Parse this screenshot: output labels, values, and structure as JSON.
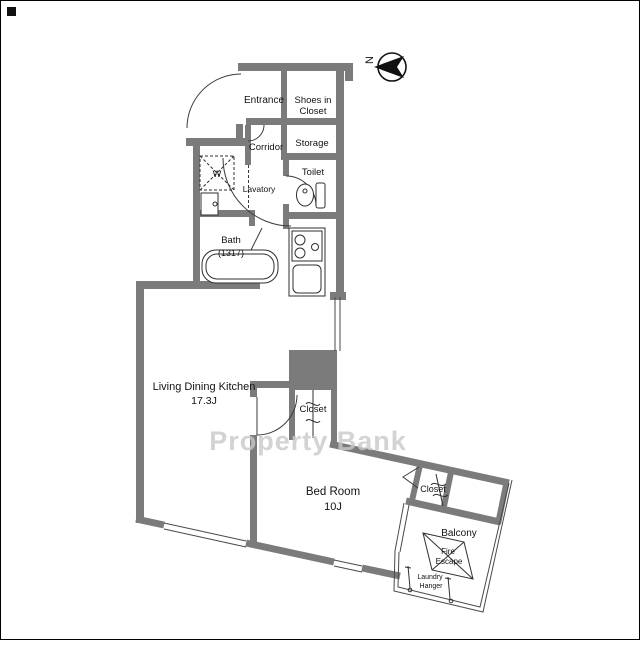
{
  "plan": {
    "watermark": "Property Bank",
    "compass": {
      "north_label": "N"
    },
    "rooms": {
      "entrance": {
        "label": "Entrance"
      },
      "shoes_in_closet": {
        "line1": "Shoes in",
        "line2": "Closet"
      },
      "corridor": {
        "label": "Corridor"
      },
      "storage": {
        "label": "Storage"
      },
      "toilet": {
        "label": "Toilet"
      },
      "washing_machine": {
        "label": "W"
      },
      "lavatory": {
        "label": "Lavatory"
      },
      "bath": {
        "label": "Bath",
        "size": "(1317)"
      },
      "living_dining_kitchen": {
        "label": "Living Dining Kitchen",
        "size": "17.3J"
      },
      "hall_closet": {
        "label": "Closet"
      },
      "bedroom": {
        "label": "Bed Room",
        "size": "10J"
      },
      "bedroom_closet": {
        "label": "Closet"
      },
      "balcony": {
        "label": "Balcony"
      },
      "fire_escape": {
        "line1": "Fire",
        "line2": "Escape"
      },
      "laundry_hanger": {
        "line1": "Laundry",
        "line2": "Hanger"
      }
    },
    "colors": {
      "wall": "#7b7b7b",
      "line": "#2f2f2f",
      "watermark": "#c9c9c9",
      "background": "#ffffff"
    }
  }
}
